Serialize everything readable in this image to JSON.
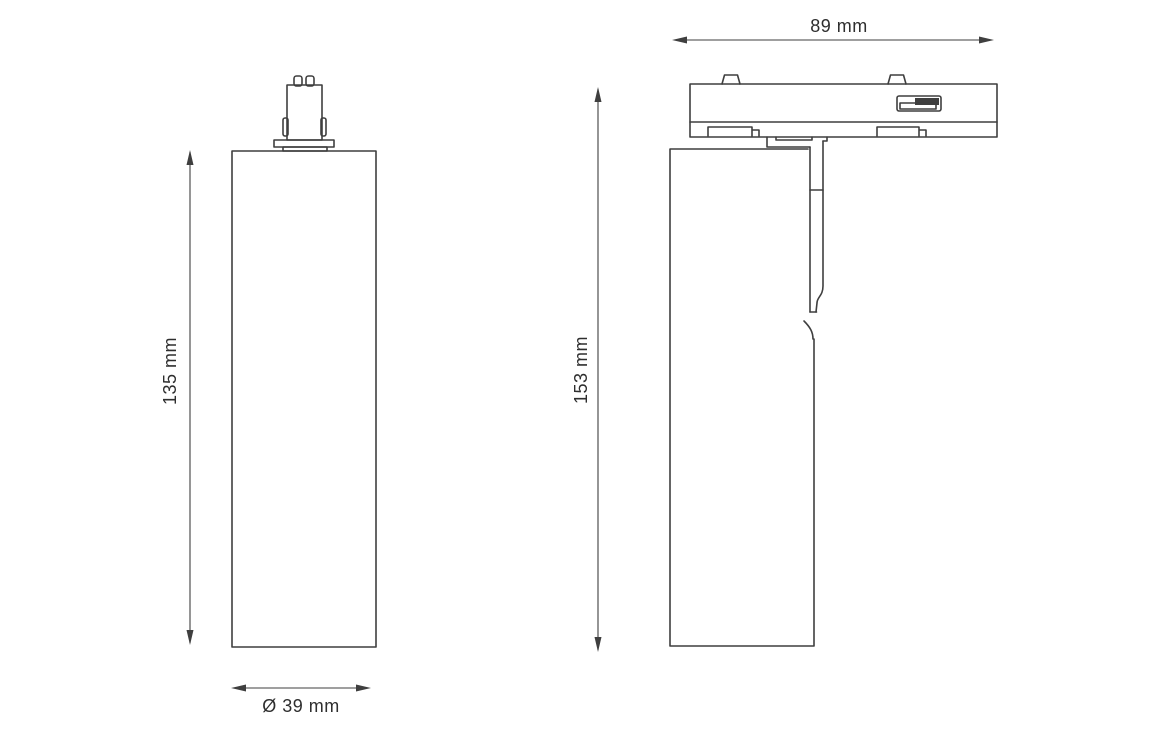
{
  "drawing": {
    "kind": "technical-dimension-drawing",
    "dimensions": {
      "front_height_label": "135 mm",
      "front_diameter_label": "Ø 39 mm",
      "side_width_label": "89 mm",
      "side_height_label": "153 mm"
    }
  },
  "colors": {
    "line": "#3f3f3f",
    "text": "#2e2e2e",
    "background": "#ffffff"
  }
}
